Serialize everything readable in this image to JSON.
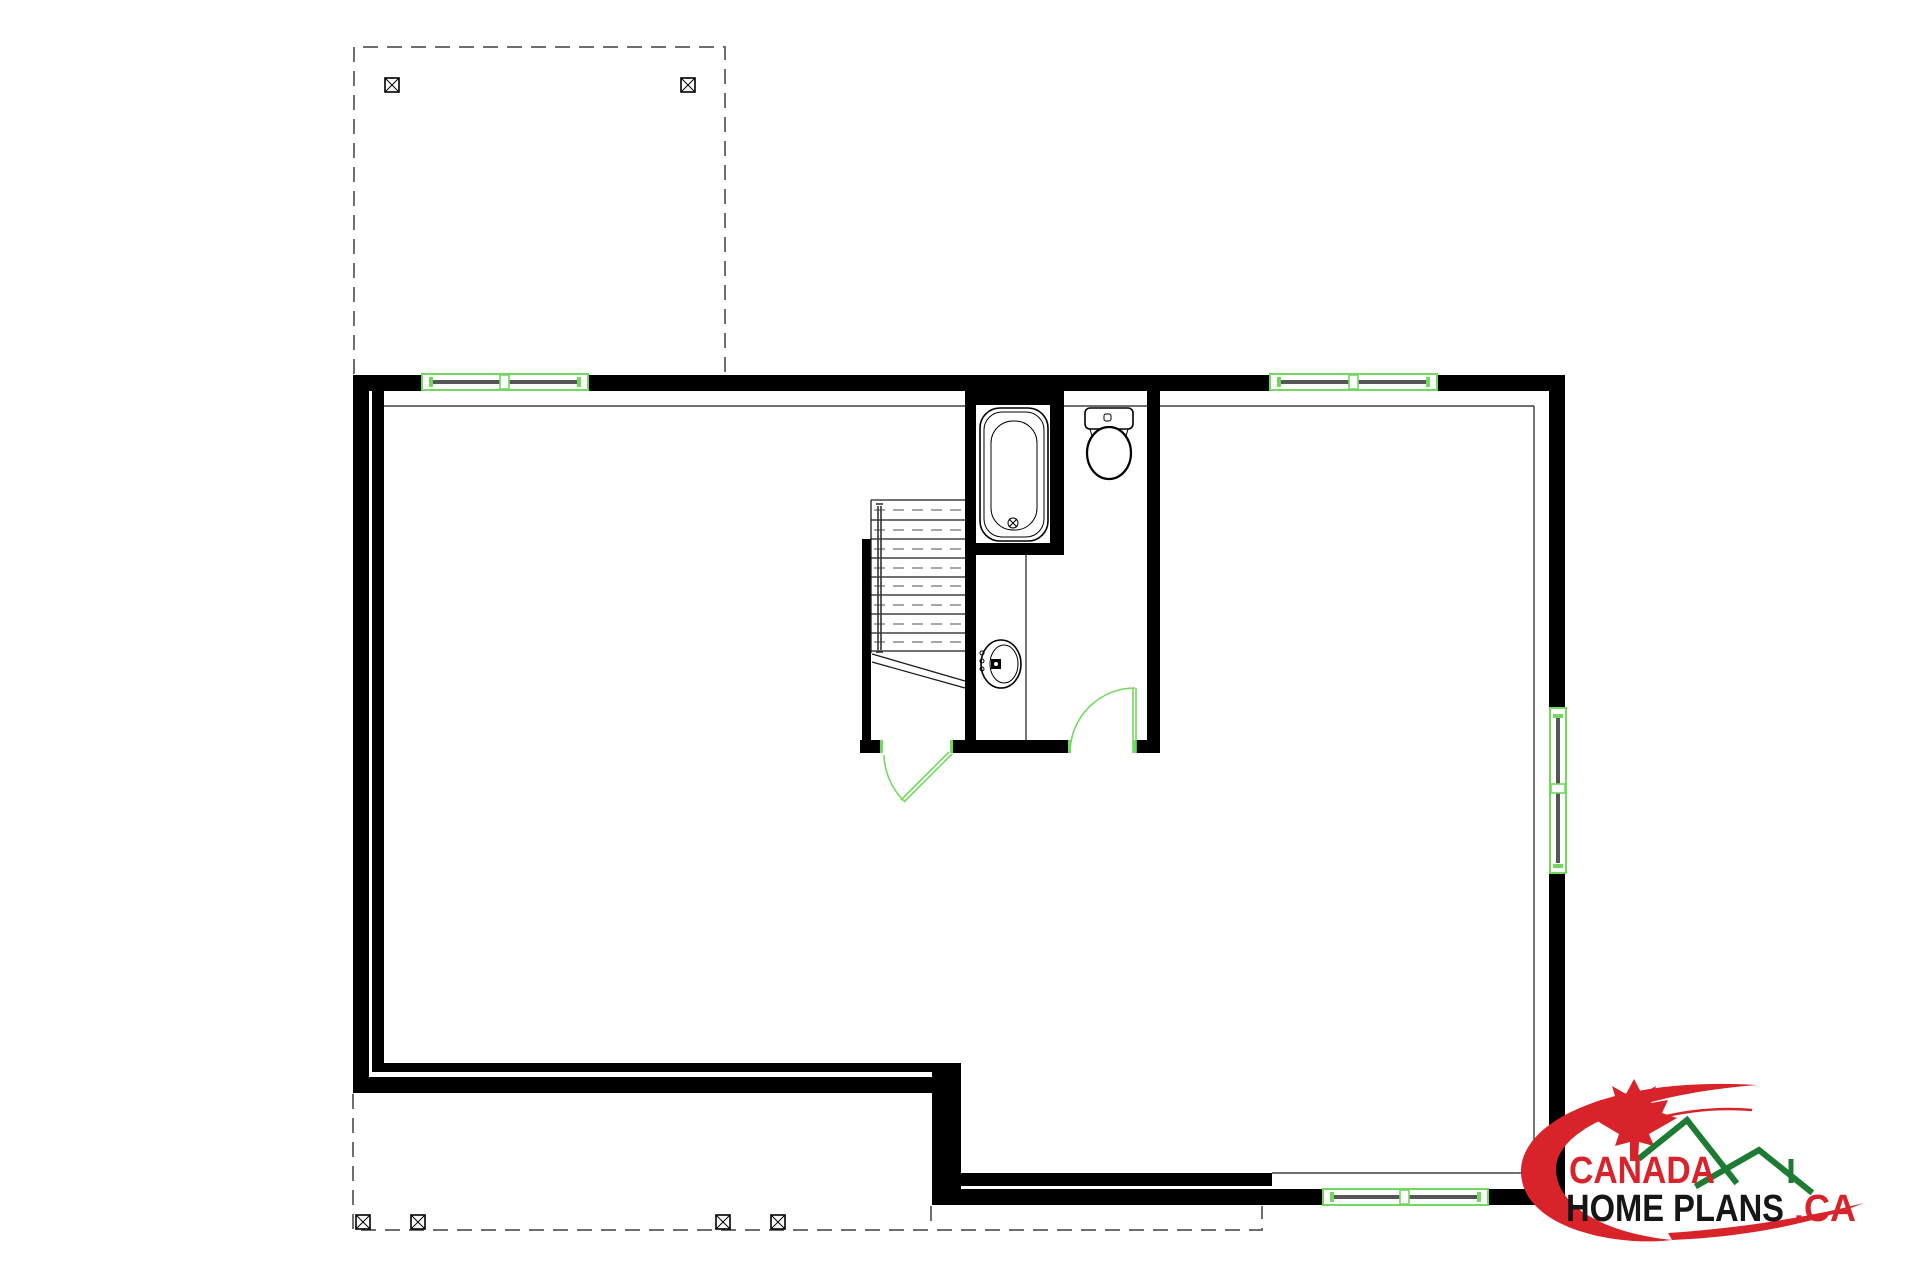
{
  "logo": {
    "brand_top": "CANADA",
    "brand_bottom": "HOME PLANS",
    "brand_suffix": ".CA"
  },
  "colors": {
    "background": "#ffffff",
    "wall": "#000000",
    "line": "#1a1a1a",
    "dashed": "#6e6e6e",
    "plan_green": "#72d95f",
    "sill_gray": "#565656",
    "logo_red": "#d8232a",
    "logo_green": "#1e7b34",
    "logo_text": "#161616"
  },
  "plan": {
    "windows_count": 4,
    "doors_count": 2,
    "stair_treads": 9,
    "deck_post_markers": 6,
    "fixtures": [
      "bathtub",
      "toilet",
      "sink"
    ]
  }
}
